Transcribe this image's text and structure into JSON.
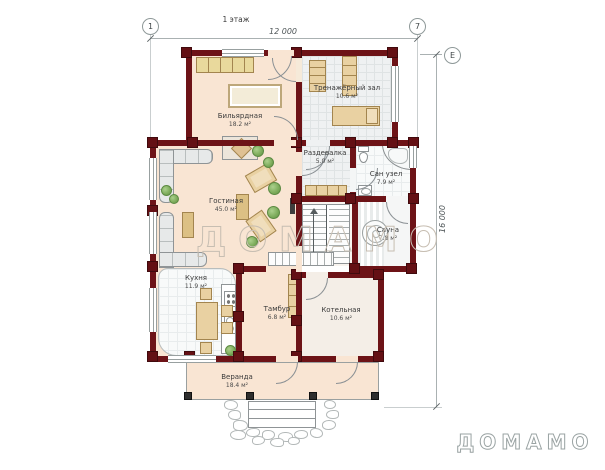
{
  "annotations": {
    "floor_label": "1 этаж",
    "grid": {
      "left_marker": "1",
      "right_marker": "7",
      "row_marker": "Е"
    },
    "dim_width": "12 000",
    "dim_height": "16 000"
  },
  "watermark": "ДОМАМО",
  "brand_logo": "ДОМАМО",
  "rooms": [
    {
      "name": "Бильярдная",
      "area": "18.2 м²"
    },
    {
      "name": "Тренажёрный зал",
      "area": "10.6 м²"
    },
    {
      "name": "Раздевалка",
      "area": "5.0 м²"
    },
    {
      "name": "Сан узел",
      "area": "7.9 м²"
    },
    {
      "name": "Гостиная",
      "area": "45.0 м²"
    },
    {
      "name": "Сауна",
      "area": "7.8 м²"
    },
    {
      "name": "Кухня",
      "area": "11.9 м²"
    },
    {
      "name": "Тамбур",
      "area": "6.8 м²"
    },
    {
      "name": "Котельная",
      "area": "10.6 м²"
    },
    {
      "name": "Веранда",
      "area": "18.4 м²"
    }
  ],
  "colors": {
    "wall": "#6d1317",
    "warm_floor": "#f9e5d3",
    "wood_furniture": "#e9d1a2",
    "tile_floor": "#eff1f2"
  }
}
